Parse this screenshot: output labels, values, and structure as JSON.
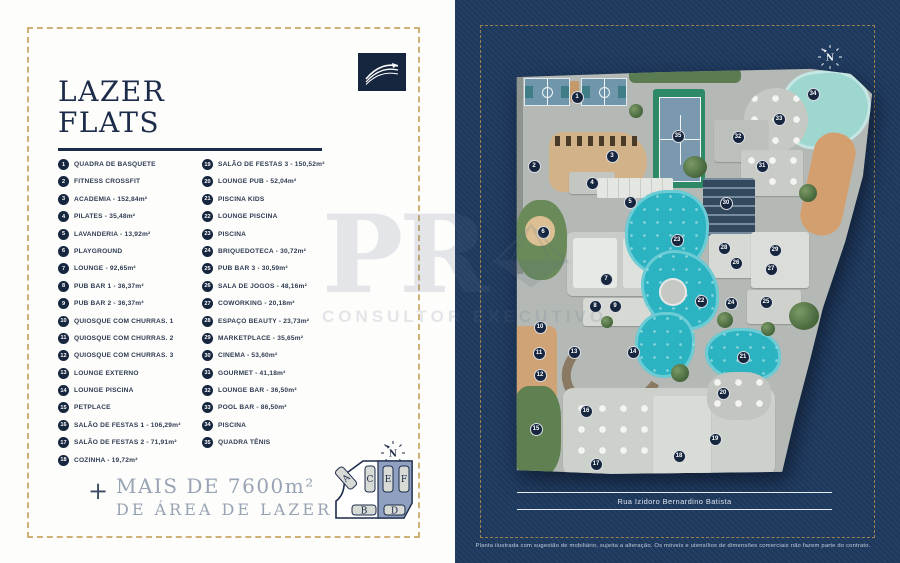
{
  "colors": {
    "navy_text": "#1c2b4a",
    "panel_navy": "#1e3a5f",
    "gold_border": "#c8a35f",
    "pool_turquoise": "#2cb3c1",
    "footer_muted": "#98a3b4",
    "logo_gold": "#c9a23c"
  },
  "left_panel": {
    "title_line1": "LAZER",
    "title_line2": "FLATS",
    "legend_items": [
      {
        "n": 1,
        "label": "QUADRA DE BASQUETE"
      },
      {
        "n": 2,
        "label": "FITNESS CROSSFIT"
      },
      {
        "n": 3,
        "label": "ACADEMIA - 152,84m²"
      },
      {
        "n": 4,
        "label": "PILATES - 35,48m²"
      },
      {
        "n": 5,
        "label": "LAVANDERIA - 13,92m²"
      },
      {
        "n": 6,
        "label": "PLAYGROUND"
      },
      {
        "n": 7,
        "label": "LOUNGE - 92,65m²"
      },
      {
        "n": 8,
        "label": "PUB BAR 1 - 36,37m²"
      },
      {
        "n": 9,
        "label": "PUB BAR 2 - 36,37m²"
      },
      {
        "n": 10,
        "label": "QUIOSQUE COM CHURRAS. 1"
      },
      {
        "n": 11,
        "label": "QUIOSQUE COM CHURRAS. 2"
      },
      {
        "n": 12,
        "label": "QUIOSQUE COM CHURRAS. 3"
      },
      {
        "n": 13,
        "label": "LOUNGE EXTERNO"
      },
      {
        "n": 14,
        "label": "LOUNGE PISCINA"
      },
      {
        "n": 15,
        "label": "PETPLACE"
      },
      {
        "n": 16,
        "label": "SALÃO DE FESTAS 1 - 106,29m²"
      },
      {
        "n": 17,
        "label": "SALÃO DE FESTAS 2 - 71,91m²"
      },
      {
        "n": 18,
        "label": "COZINHA - 19,72m²"
      },
      {
        "n": 19,
        "label": "SALÃO DE FESTAS 3 - 150,52m²"
      },
      {
        "n": 20,
        "label": "LOUNGE PUB - 52,04m²"
      },
      {
        "n": 21,
        "label": "PISCINA KIDS"
      },
      {
        "n": 22,
        "label": "LOUNGE PISCINA"
      },
      {
        "n": 23,
        "label": "PISCINA"
      },
      {
        "n": 24,
        "label": "BRIQUEDOTECA - 30,72m²"
      },
      {
        "n": 25,
        "label": "PUB BAR 3 - 30,59m²"
      },
      {
        "n": 26,
        "label": "SALA DE JOGOS - 48,16m²"
      },
      {
        "n": 27,
        "label": "COWORKING - 20,18m²"
      },
      {
        "n": 28,
        "label": "ESPAÇO BEAUTY - 23,73m²"
      },
      {
        "n": 29,
        "label": "MARKETPLACE - 35,65m²"
      },
      {
        "n": 30,
        "label": "CINEMA - 53,60m²"
      },
      {
        "n": 31,
        "label": "GOURMET - 41,18m²"
      },
      {
        "n": 32,
        "label": "LOUNGE BAR - 36,50m²"
      },
      {
        "n": 33,
        "label": "POOL BAR - 86,50m²"
      },
      {
        "n": 34,
        "label": "PISCINA"
      },
      {
        "n": 35,
        "label": "QUADRA TÊNIS"
      }
    ],
    "footer_plus": "+",
    "footer_line1": "MAIS DE 7600m²",
    "footer_line2": "DE ÁREA DE LAZER",
    "compass_label": "N",
    "key_plan_buildings": [
      "A",
      "C",
      "E",
      "F",
      "B",
      "D"
    ]
  },
  "right_panel": {
    "compass_label": "N",
    "street_label": "Rua Izidoro Bernardino Batista",
    "disclaimer": "Planta ilustrada com sugestão de mobiliário, sujeita a alteração. Os móveis e utensílios de dimensões comerciais não fazem parte do contrato.",
    "logo": {
      "monogram": "PR",
      "subtitle": "CONSULTOR EXECUTIVO"
    },
    "map_markers": [
      {
        "n": 1,
        "x": 66,
        "y": 31
      },
      {
        "n": 2,
        "x": 23,
        "y": 100
      },
      {
        "n": 3,
        "x": 101,
        "y": 90
      },
      {
        "n": 4,
        "x": 81,
        "y": 117
      },
      {
        "n": 5,
        "x": 119,
        "y": 136
      },
      {
        "n": 6,
        "x": 32,
        "y": 166
      },
      {
        "n": 7,
        "x": 95,
        "y": 213
      },
      {
        "n": 8,
        "x": 84,
        "y": 240
      },
      {
        "n": 9,
        "x": 104,
        "y": 240
      },
      {
        "n": 10,
        "x": 29,
        "y": 261
      },
      {
        "n": 11,
        "x": 28,
        "y": 287
      },
      {
        "n": 12,
        "x": 29,
        "y": 309
      },
      {
        "n": 13,
        "x": 63,
        "y": 286
      },
      {
        "n": 14,
        "x": 122,
        "y": 286
      },
      {
        "n": 15,
        "x": 25,
        "y": 363
      },
      {
        "n": 16,
        "x": 75,
        "y": 345
      },
      {
        "n": 17,
        "x": 85,
        "y": 398
      },
      {
        "n": 18,
        "x": 168,
        "y": 390
      },
      {
        "n": 19,
        "x": 204,
        "y": 373
      },
      {
        "n": 20,
        "x": 212,
        "y": 327
      },
      {
        "n": 21,
        "x": 232,
        "y": 291
      },
      {
        "n": 22,
        "x": 190,
        "y": 235
      },
      {
        "n": 23,
        "x": 166,
        "y": 174
      },
      {
        "n": 24,
        "x": 220,
        "y": 237
      },
      {
        "n": 25,
        "x": 255,
        "y": 236
      },
      {
        "n": 26,
        "x": 225,
        "y": 197
      },
      {
        "n": 27,
        "x": 260,
        "y": 203
      },
      {
        "n": 28,
        "x": 213,
        "y": 182
      },
      {
        "n": 29,
        "x": 264,
        "y": 184
      },
      {
        "n": 30,
        "x": 215,
        "y": 137
      },
      {
        "n": 31,
        "x": 251,
        "y": 100
      },
      {
        "n": 32,
        "x": 227,
        "y": 71
      },
      {
        "n": 33,
        "x": 268,
        "y": 53
      },
      {
        "n": 34,
        "x": 302,
        "y": 28
      },
      {
        "n": 35,
        "x": 167,
        "y": 70
      }
    ]
  },
  "watermark": {
    "monogram": "PR",
    "subtitle": "CONSULTOR EXECUTIVO"
  }
}
